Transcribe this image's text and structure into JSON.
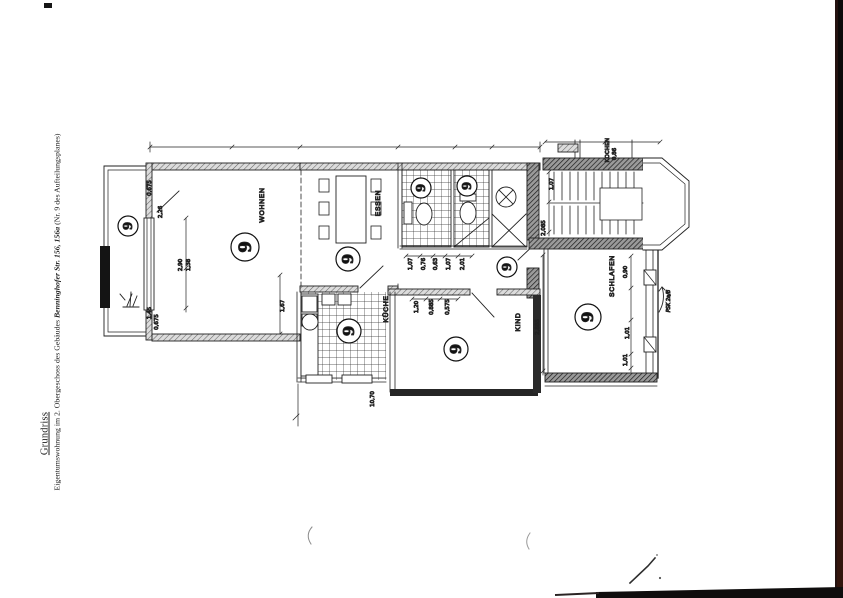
{
  "document": {
    "title": "Grundriss",
    "subtitle_prefix": "Eigentumswohnung im 2. Obergeschoss des Gebäudes ",
    "subtitle_emphasis": "Benninghofer Str. 156, 156a",
    "subtitle_suffix": " (Nr. 9 des Aufteilungsplanes)"
  },
  "plan": {
    "unit_number": "9",
    "rooms": {
      "wohnen": "WOHNEN",
      "essen": "ESSEN",
      "kueche": "KÜCHE",
      "kind": "KIND",
      "schlafen": "SCHLAFEN",
      "neighbor_kochen": "KOCHEN"
    },
    "handwritten_note": "PSK 2a/B",
    "dimensions": [
      "0,675",
      "2,26",
      "2,90",
      "1,38",
      "1,45",
      "0,675",
      "1,67",
      "1,07",
      "0,76",
      "0,63",
      "1,07",
      "2,01",
      "1,20",
      "0,885",
      "0,575",
      "2,885",
      "2,085",
      "1,07",
      "0,90",
      "1,01",
      "1,01",
      "0,86",
      "10,70"
    ]
  }
}
